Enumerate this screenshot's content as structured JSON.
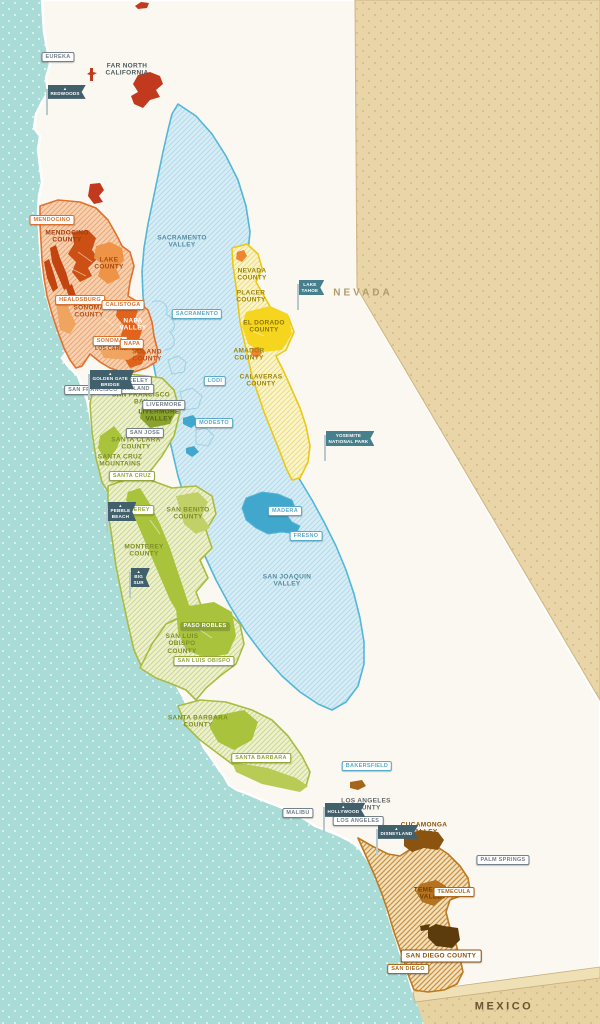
{
  "map": {
    "title": "California wine regions map",
    "colors": {
      "ocean": "#a9dcd6",
      "ocean_dot": "#ffffff",
      "land": "#faf8f0",
      "desert_tan": "#e9d5a7",
      "desert_dot": "#d2b983",
      "north_coast_orange": "#e2702e",
      "napa_solid": "#e2641c",
      "mendocino_solid": "#cc4f14",
      "valley_blue": "#54b6d8",
      "valley_lake_blue": "#42a7cc",
      "sierra_yellow": "#ecc816",
      "el_dorado_solid": "#f6d51e",
      "central_coast_green": "#a8bc42",
      "solid_green": "#a9c43c",
      "dark_green": "#8aa32c",
      "socal_brown": "#bd7a22",
      "cucamonga_solid": "#8a5310",
      "san_diego_solid": "#5c3c0c",
      "far_north_red": "#c13a1e",
      "flag_dark": "#41606c",
      "flag_teal": "#47808d"
    },
    "region_labels": [
      {
        "text": "FAR NORTH\nCALIFORNIA",
        "x": 127,
        "y": 70,
        "color": "#4e5a60"
      },
      {
        "text": "MENDOCINO\nCOUNTY",
        "x": 67,
        "y": 237,
        "color": "#a03c10"
      },
      {
        "text": "LAKE\nCOUNTY",
        "x": 109,
        "y": 264,
        "color": "#a84a10"
      },
      {
        "text": "SONOMA\nCOUNTY",
        "x": 89,
        "y": 312,
        "color": "#b5521a"
      },
      {
        "text": "NAPA\nVALLEY",
        "x": 133,
        "y": 325,
        "color": "#ffffff"
      },
      {
        "text": "LOS CARNEROS",
        "x": 117,
        "y": 350,
        "color": "#b5521a",
        "size": 5
      },
      {
        "text": "SOLANO\nCOUNTY",
        "x": 147,
        "y": 356,
        "color": "#b5521a"
      },
      {
        "text": "SACRAMENTO\nVALLEY",
        "x": 182,
        "y": 242,
        "color": "#578ca2"
      },
      {
        "text": "SAN JOAQUIN\nVALLEY",
        "x": 287,
        "y": 581,
        "color": "#578ca2"
      },
      {
        "text": "NEVADA\nCOUNTY",
        "x": 252,
        "y": 275,
        "color": "#9c850c"
      },
      {
        "text": "PLACER\nCOUNTY",
        "x": 251,
        "y": 297,
        "color": "#9c850c"
      },
      {
        "text": "EL DORADO\nCOUNTY",
        "x": 264,
        "y": 327,
        "color": "#8a760a"
      },
      {
        "text": "AMADOR\nCOUNTY",
        "x": 249,
        "y": 355,
        "color": "#9c850c"
      },
      {
        "text": "CALAVERAS\nCOUNTY",
        "x": 261,
        "y": 381,
        "color": "#9c850c"
      },
      {
        "text": "SAN FRANCISCO\nBAY",
        "x": 141,
        "y": 399,
        "color": "#7d8f26"
      },
      {
        "text": "LIVERMORE\nVALLEY",
        "x": 159,
        "y": 416,
        "color": "#55661a"
      },
      {
        "text": "SANTA CLARA\nCOUNTY",
        "x": 136,
        "y": 444,
        "color": "#7d8f26"
      },
      {
        "text": "SANTA CRUZ\nMOUNTAINS",
        "x": 120,
        "y": 461,
        "color": "#7d8f26"
      },
      {
        "text": "SAN BENITO\nCOUNTY",
        "x": 188,
        "y": 514,
        "color": "#7d8f26"
      },
      {
        "text": "MONTEREY\nCOUNTY",
        "x": 144,
        "y": 551,
        "color": "#7d8f26"
      },
      {
        "text": "SAN LUIS\nOBISPO\nCOUNTY",
        "x": 182,
        "y": 644,
        "color": "#7d8f26"
      },
      {
        "text": "SANTA BARBARA\nCOUNTY",
        "x": 198,
        "y": 722,
        "color": "#7d8f26"
      },
      {
        "text": "LOS ANGELES\nCOUNTY",
        "x": 366,
        "y": 805,
        "color": "#5f666d"
      },
      {
        "text": "CUCAMONGA\nVALLEY",
        "x": 424,
        "y": 829,
        "color": "#8a5310"
      },
      {
        "text": "TEMECULA\nVALLEY",
        "x": 433,
        "y": 894,
        "color": "#6d4208"
      },
      {
        "text": "NEVADA",
        "x": 363,
        "y": 293,
        "color": "#b39b6b",
        "size": 10,
        "spacing": 3
      },
      {
        "text": "MEXICO",
        "x": 504,
        "y": 1007,
        "color": "#6b5232",
        "size": 11,
        "spacing": 2.5
      }
    ],
    "city_tags": [
      {
        "text": "EUREKA",
        "x": 58,
        "y": 57,
        "color": "#74808a"
      },
      {
        "text": "MENDOCINO",
        "x": 52,
        "y": 220,
        "color": "#d9722e"
      },
      {
        "text": "HEALDSBURG",
        "x": 80,
        "y": 300,
        "color": "#d9722e"
      },
      {
        "text": "CALISTOGA",
        "x": 123,
        "y": 305,
        "color": "#d9722e"
      },
      {
        "text": "SONOMA",
        "x": 110,
        "y": 341,
        "color": "#d9722e"
      },
      {
        "text": "NAPA",
        "x": 132,
        "y": 344,
        "color": "#d9722e"
      },
      {
        "text": "SACRAMENTO",
        "x": 197,
        "y": 314,
        "color": "#5aabca"
      },
      {
        "text": "LODI",
        "x": 215,
        "y": 381,
        "color": "#5aabca"
      },
      {
        "text": "MODESTO",
        "x": 214,
        "y": 423,
        "color": "#5aabca"
      },
      {
        "text": "BERKELEY",
        "x": 132,
        "y": 381,
        "color": "#74808a"
      },
      {
        "text": "OAKLAND",
        "x": 135,
        "y": 389,
        "color": "#74808a"
      },
      {
        "text": "SAN FRANCISCO",
        "x": 93,
        "y": 390,
        "color": "#74808a"
      },
      {
        "text": "LIVERMORE",
        "x": 164,
        "y": 405,
        "color": "#74808a"
      },
      {
        "text": "SAN JOSE",
        "x": 145,
        "y": 433,
        "color": "#74808a"
      },
      {
        "text": "SANTA CRUZ",
        "x": 132,
        "y": 476,
        "color": "#93a839"
      },
      {
        "text": "MONTEREY",
        "x": 133,
        "y": 510,
        "color": "#93a839"
      },
      {
        "text": "MADERA",
        "x": 285,
        "y": 511,
        "color": "#5aabca"
      },
      {
        "text": "FRESNO",
        "x": 306,
        "y": 536,
        "color": "#5aabca"
      },
      {
        "text": "PASO ROBLES",
        "x": 205,
        "y": 626,
        "color": "#8aa32c",
        "solid": true
      },
      {
        "text": "SAN LUIS OBISPO",
        "x": 204,
        "y": 661,
        "color": "#93a839"
      },
      {
        "text": "SANTA BARBARA",
        "x": 261,
        "y": 758,
        "color": "#93a839"
      },
      {
        "text": "BAKERSFIELD",
        "x": 367,
        "y": 766,
        "color": "#5aabca"
      },
      {
        "text": "MALIBU",
        "x": 298,
        "y": 813,
        "color": "#74808a"
      },
      {
        "text": "LOS ANGELES",
        "x": 358,
        "y": 821,
        "color": "#74808a"
      },
      {
        "text": "PALM SPRINGS",
        "x": 503,
        "y": 860,
        "color": "#74808a"
      },
      {
        "text": "TEMECULA",
        "x": 454,
        "y": 892,
        "color": "#a9681c"
      },
      {
        "text": "SAN DIEGO COUNTY",
        "x": 441,
        "y": 956,
        "color": "#8a5310",
        "big": true
      },
      {
        "text": "SAN DIEGO",
        "x": 408,
        "y": 969,
        "color": "#a9681c"
      }
    ],
    "flags": [
      {
        "text": "REDWOODS",
        "x": 46,
        "y": 85,
        "variant": "dark",
        "icon": true
      },
      {
        "text": "LAKE\nTAHOE",
        "x": 297,
        "y": 280,
        "variant": "teal"
      },
      {
        "text": "YOSEMITE\nNATIONAL PARK",
        "x": 324,
        "y": 431,
        "variant": "teal"
      },
      {
        "text": "GOLDEN GATE\nBRIDGE",
        "x": 88,
        "y": 370,
        "variant": "dark",
        "icon": true
      },
      {
        "text": "PEBBLE\nBEACH",
        "x": 106,
        "y": 502,
        "variant": "dark",
        "icon": true
      },
      {
        "text": "BIG\nSUR",
        "x": 129,
        "y": 568,
        "variant": "dark",
        "icon": true
      },
      {
        "text": "HOLLYWOOD",
        "x": 323,
        "y": 803,
        "variant": "dark",
        "icon": true
      },
      {
        "text": "DISNEYLAND",
        "x": 376,
        "y": 825,
        "variant": "dark",
        "icon": true
      }
    ]
  }
}
